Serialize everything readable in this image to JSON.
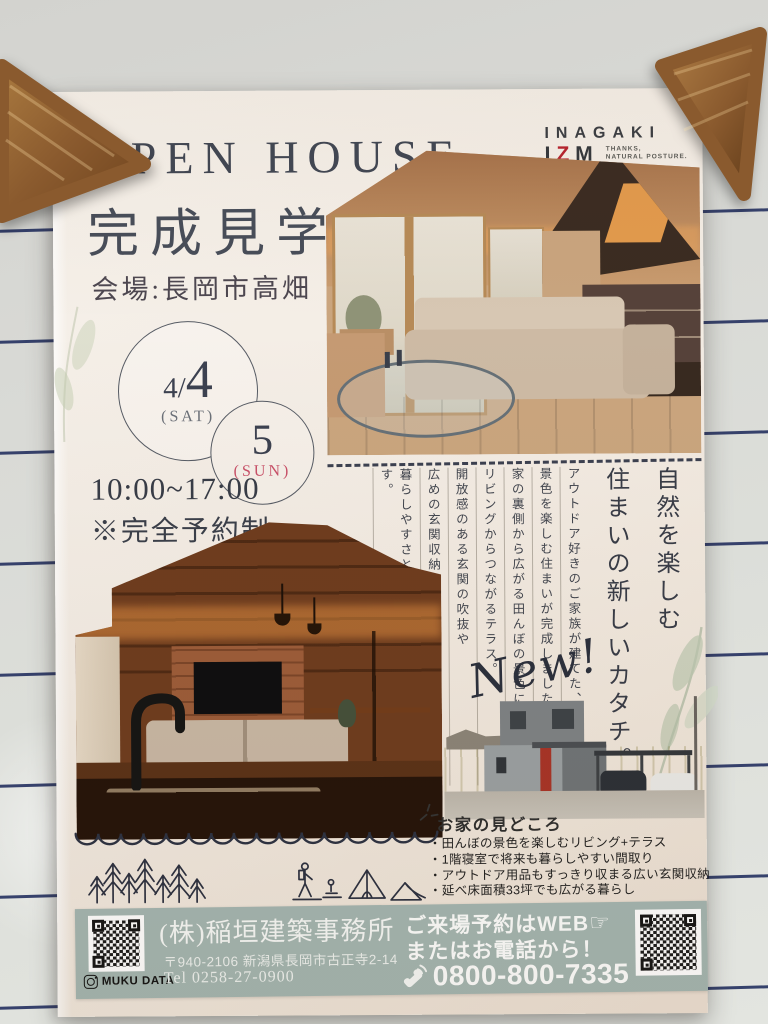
{
  "scene": {
    "whiteboard_color": "#d9dad6",
    "rule_color": "#24305f",
    "wood_magnet_color": "#8a5a2e"
  },
  "poster": {
    "logo": {
      "name": "INAGAKI",
      "izm_i": "I",
      "izm_z": "Z",
      "izm_m": "M",
      "tagline_1": "THANKS,",
      "tagline_2": "NATURAL POSTURE.",
      "accent_color": "#b6222e"
    },
    "title": {
      "first_letter": "O",
      "rest": "PEN HOUSE",
      "jp": "完成見学会",
      "accent_color": "#b3242f"
    },
    "venue": "会場:長岡市高畑",
    "dates": [
      {
        "num_small": "4/",
        "num_big": "4",
        "label": "(SAT)"
      },
      {
        "num_small": "",
        "num_big": "5",
        "label": "(SUN)",
        "label_color": "#c85068"
      }
    ],
    "time": "10:00~17:00",
    "note": "※完全予約制",
    "lead": {
      "headline_1": "自然を楽しむ",
      "headline_2": "住まいの新しいカタチ。",
      "body": [
        "アウトドア好きのご家族が建てた、",
        "景色を楽しむ住まいが完成しました。",
        "家の裏側から広がる田んぼの景色に向かって",
        "リビングからつながるテラス。",
        "開放感のある玄関の吹抜や",
        "広めの玄関収納など、",
        "暮らしやすさと遊び心を詰め込んだ住まいです。"
      ],
      "new_badge": "New!"
    },
    "highlights": {
      "heading": "お家の見どころ",
      "items": [
        "・田んぼの景色を楽しむリビング+テラス",
        "・1階寝室で将来も暮らしやすい間取り",
        "・アウトドア用品もすっきり収まる広い玄関収納",
        "・延べ床面積33坪でも広がる暮らし"
      ]
    },
    "footer": {
      "bg_color": "#a4b6b1",
      "company": "(株)稲垣建築事務所",
      "address": "〒940-2106 新潟県長岡市古正寺2-14",
      "tel": "Tel 0258-27-0900",
      "instagram_label": "MUKU DATA",
      "cta_1": "ご来場予約はWEB",
      "cta_2": "またはお電話から！",
      "phone": "0800-800-7335"
    }
  }
}
